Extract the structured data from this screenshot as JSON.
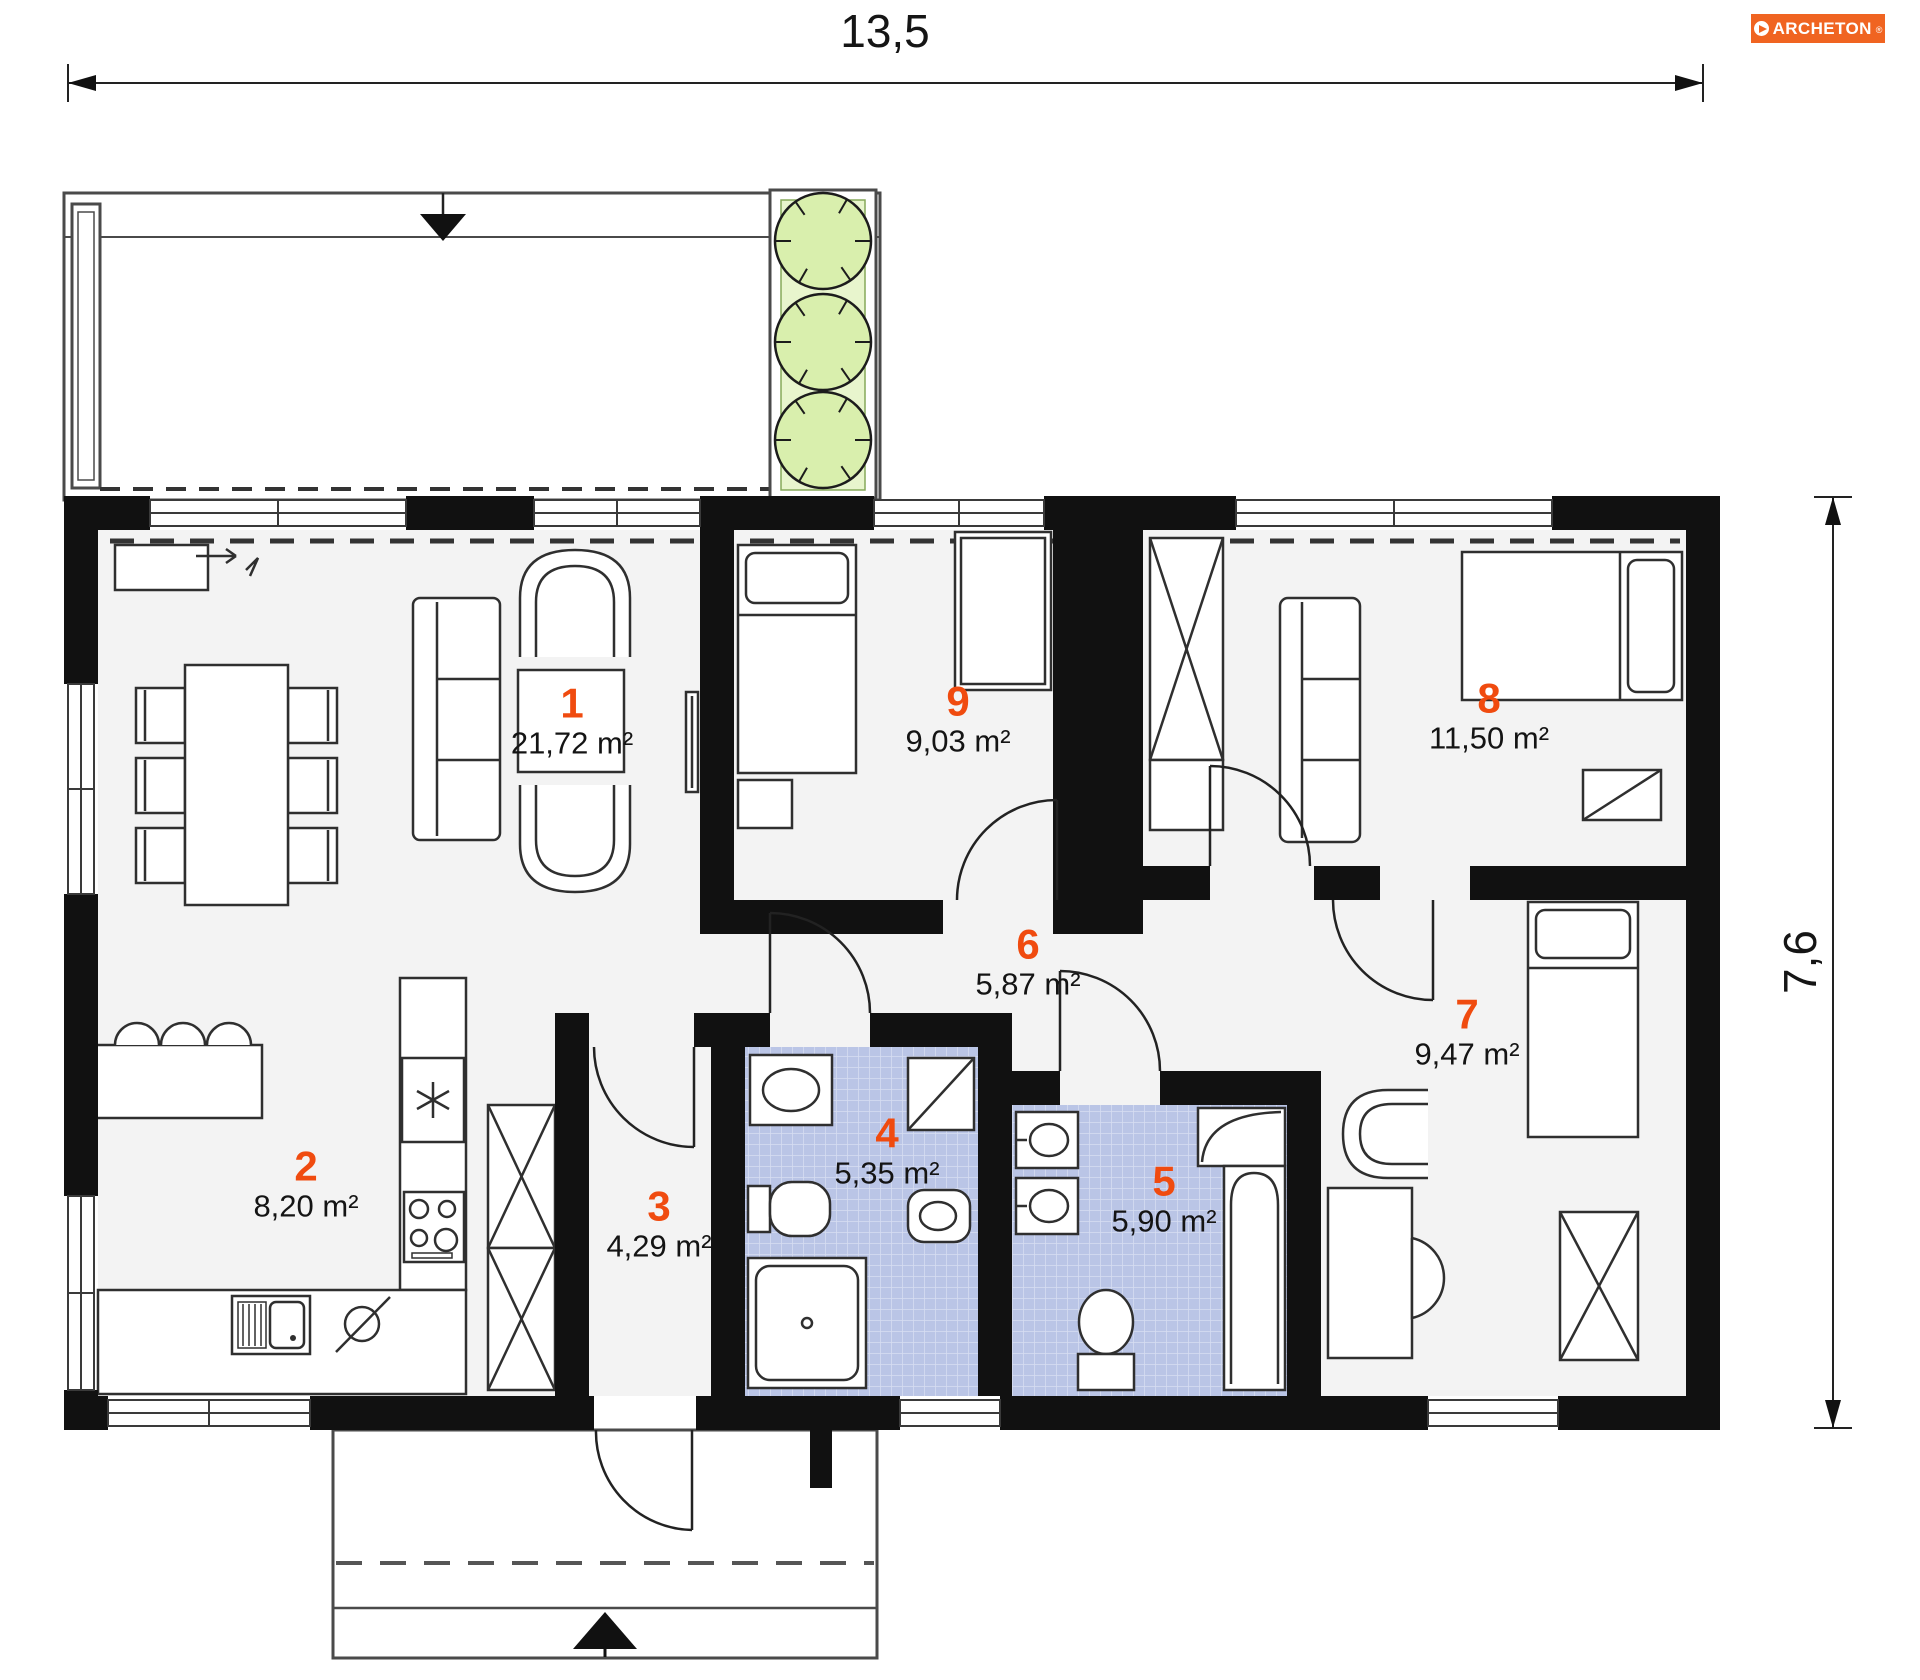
{
  "brand": {
    "name": "ARCHETON",
    "registered": "®"
  },
  "dimensions": {
    "width_m": "13,5",
    "height_m": "7,6"
  },
  "rooms": [
    {
      "number": "1",
      "area": "21,72 m²"
    },
    {
      "number": "2",
      "area": "8,20 m²"
    },
    {
      "number": "3",
      "area": "4,29 m²"
    },
    {
      "number": "4",
      "area": "5,35 m²"
    },
    {
      "number": "5",
      "area": "5,90 m²"
    },
    {
      "number": "6",
      "area": "5,87 m²"
    },
    {
      "number": "7",
      "area": "9,47 m²"
    },
    {
      "number": "8",
      "area": "11,50 m²"
    },
    {
      "number": "9",
      "area": "9,03 m²"
    }
  ],
  "colors": {
    "accent_number": "#f04b0f",
    "logo_background": "#f06421",
    "wall": "#111111",
    "floor": "#f3f3f3",
    "bath_tile": "#bac5e6",
    "tree_fill": "#d9efad"
  }
}
